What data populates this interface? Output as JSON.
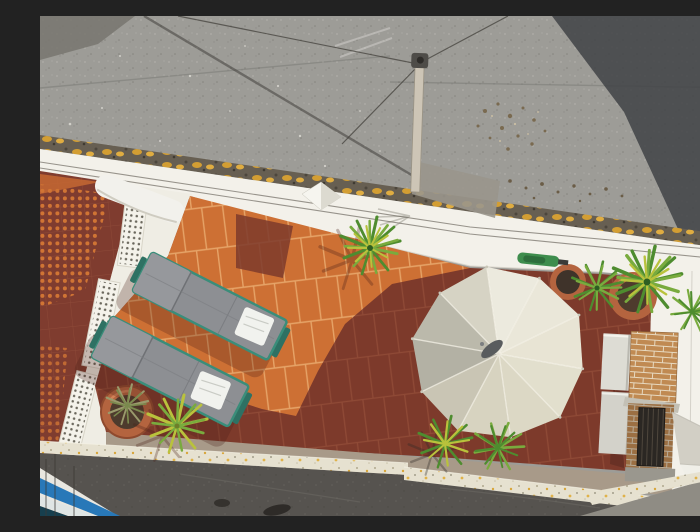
{
  "meta": {
    "width": 700,
    "height": 500,
    "alt": "Aerial top-down drone view of a rooftop terrace: orange terracotta tiles partly in shadow, two grey sun loungers with white pillows, a large cream ten-panel parasol, potted yucca plants, a brick barbecue against white walls, a white breeze-block railing beside a neighbouring red-tiled roof, a grey asphalt roof with an antenna pole and wires above, and a dark street with a blue balcony corner below."
  },
  "palette": {
    "roof_light": "#9d9c97",
    "roof_shadow": "#3d4043",
    "roof_corner": "#78766e",
    "lichen_base": "#675f52",
    "wall_white": "#f3f1ea",
    "wall_ledge": "#efede4",
    "cement_patch": "#9a968c",
    "tile_sun": "#cd7034",
    "tile_shadow": "#7d3a2b",
    "tile_grout": "#e6a468",
    "neighbor_tile": "#7f3c2f",
    "walkway": "#a89a89",
    "speckle_base": "#e6e1d0",
    "street": "#56534f",
    "street_gray": "#8f8c84",
    "blue_accent": "#2878b8",
    "blue_dark": "#173f4e",
    "pole": "#cdc5b6",
    "wire": "#44413c",
    "pot": "#b4643f",
    "soil": "#4e3b2d",
    "brick": "#c08a52",
    "firebox": "#2b2723",
    "plant_green_dark": "#4e8c2f",
    "plant_green": "#79ab3e",
    "plant_yellow": "#b9c23c",
    "plant_dry": "#9a9a6c",
    "shadow_tint": "#4a2118",
    "pyramid_white": "#f6f5ef",
    "pyramid_shade": "#dcdad0",
    "tool_green": "#3e8d4d"
  },
  "umbrella": {
    "panel_count": 10,
    "panel_fills": [
      "#eceade",
      "#eae7d9",
      "#e8e4d4",
      "#e2dfcd",
      "#dcd8c5",
      "#d7d3c0",
      "#c9c5b4",
      "#b3b1a4",
      "#bbb9ab",
      "#d6d3c4"
    ],
    "pole_color": "#595c5e"
  },
  "loungers": {
    "count": 2,
    "fabric": "#8d8f93",
    "fabric_head": "#96989c",
    "frame": "#2e7163",
    "trim": "#3a8d7a",
    "pillow": "#f1f2ee"
  },
  "scene": {
    "setting": "rooftop terrace viewed from directly above",
    "objects": [
      "grey asphalt roof with diagonal cast shadow",
      "antenna pole with radiating wires",
      "white parapet wall with small pyramid skylight",
      "terracotta tiled terrace, part sunlit, part shaded",
      "two sun loungers with white pillows",
      "cream ten-panel parasol",
      "terracotta plant pots",
      "yucca plants",
      "white breeze-block railing",
      "neighbouring red-tiled roof with dotted sunlight",
      "brick barbecue with dark firebox",
      "speckled parapet ledge",
      "dark street below",
      "blue balcony corner"
    ]
  }
}
